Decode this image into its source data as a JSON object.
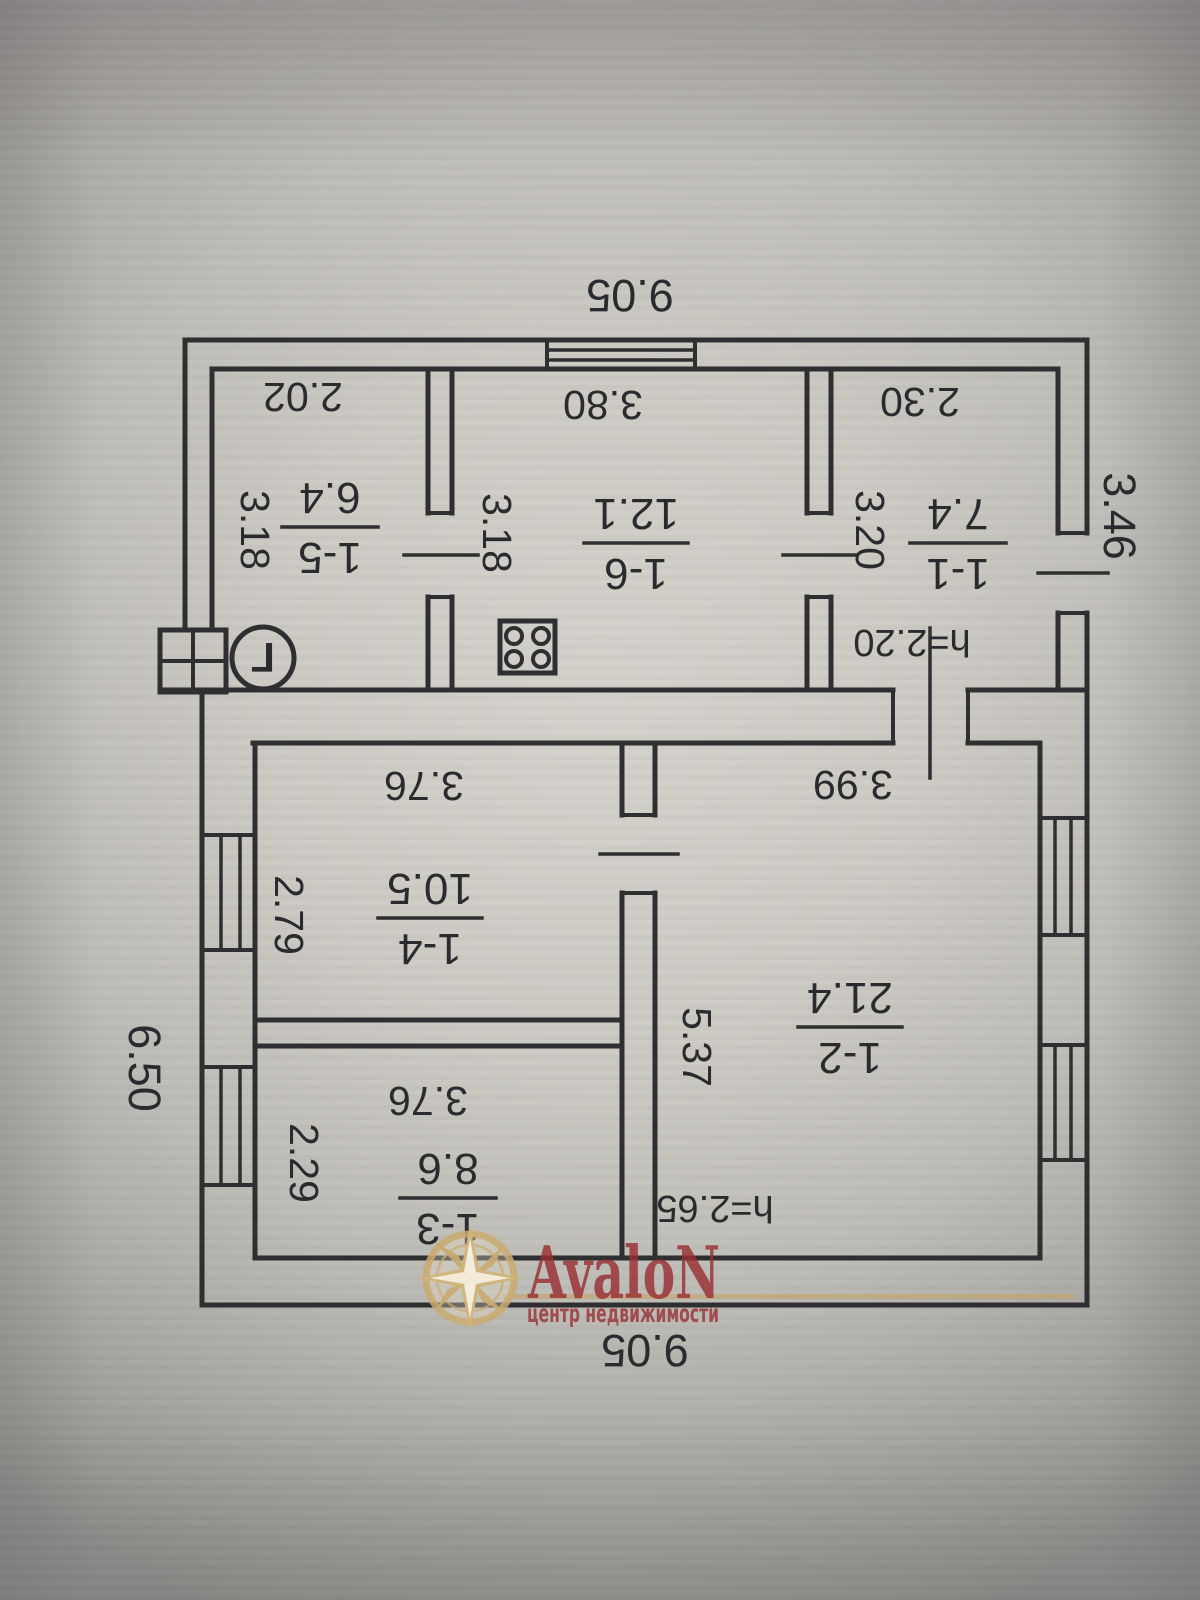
{
  "plan": {
    "dim_top": "9.05",
    "dim_bottom": "9.05",
    "dim_left": "6.50",
    "dim_right": "3.46",
    "gas_mark": "Г",
    "rooms": [
      {
        "num": "1-5",
        "area": "6.4",
        "w": "2.02",
        "h": "3.18"
      },
      {
        "num": "1-6",
        "area": "12.1",
        "w": "3.80",
        "h": "3.18"
      },
      {
        "num": "1-1",
        "area": "7.4",
        "w": "2.30",
        "h": "3.20"
      },
      {
        "num": "1-2",
        "area": "21.4",
        "w": "3.99",
        "h": "5.37"
      },
      {
        "num": "1-4",
        "area": "10.5",
        "w": "3.76",
        "h": "2.79"
      },
      {
        "num": "1-3",
        "area": "8.6",
        "w": "3.76",
        "h": "2.29"
      }
    ],
    "heights": {
      "annex": "h=2.20",
      "main": "h=2.65"
    }
  },
  "watermark": {
    "brand": "AvaloN",
    "tagline": "центр недвижимости"
  }
}
